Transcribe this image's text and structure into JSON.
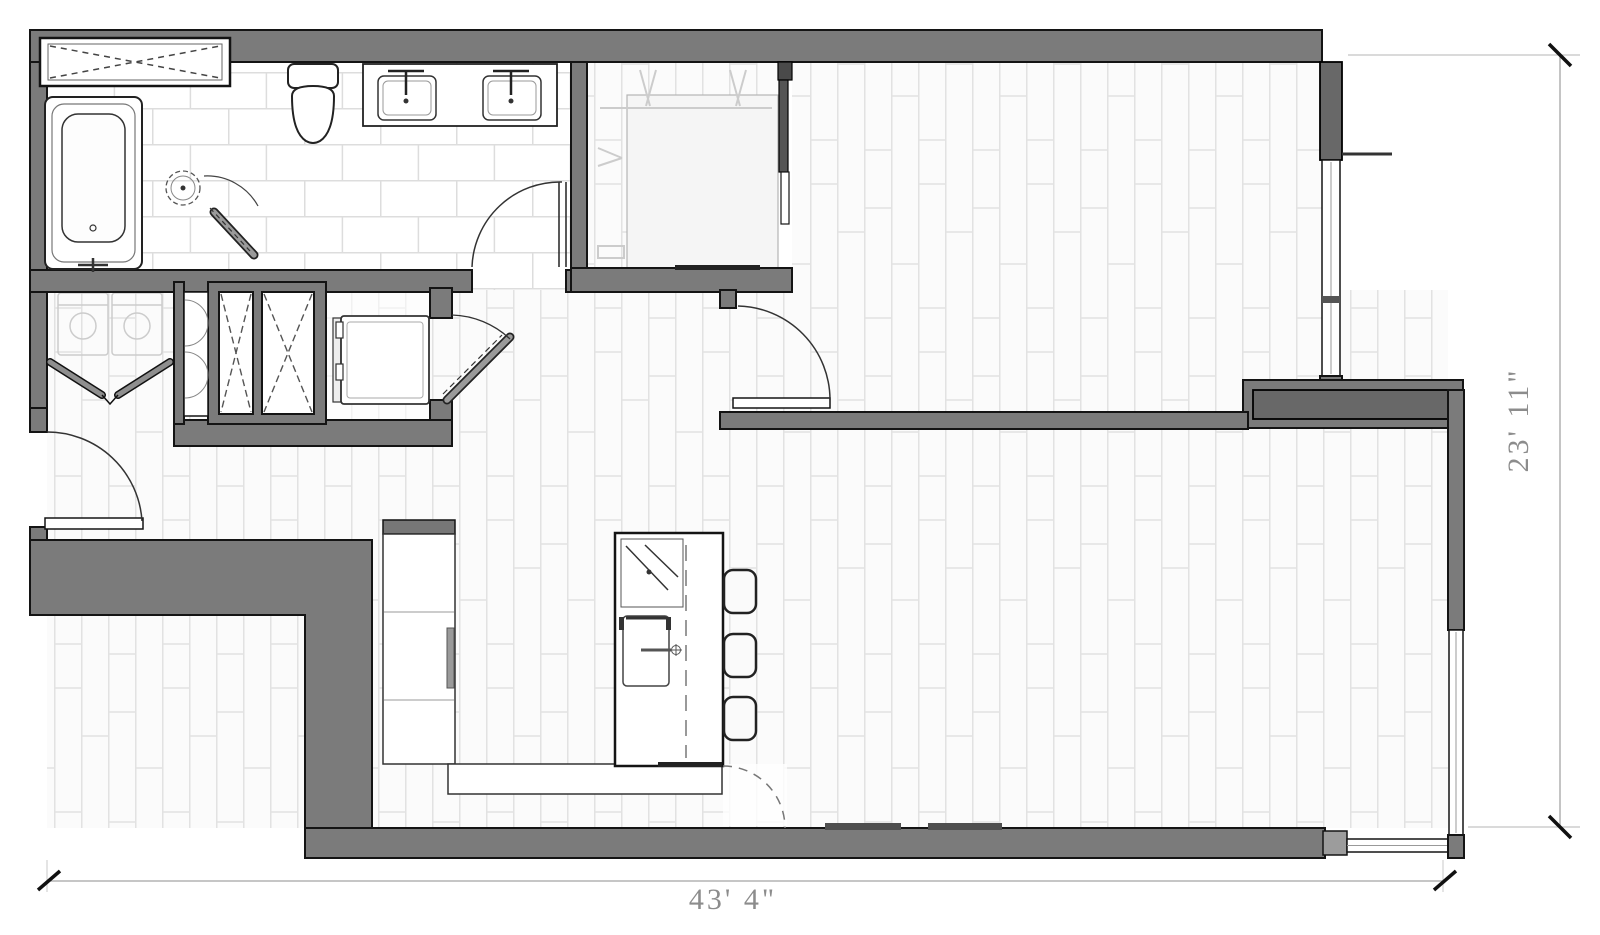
{
  "floorplan": {
    "dimensions": {
      "width_label": "43' 4\"",
      "height_label": "23' 11\""
    },
    "palette": {
      "wall_fill": "#7b7b7b",
      "wall_outline": "#141414",
      "wall_inner_band": "#686868",
      "plank_joint": "#e2e2e2",
      "tile_joint": "#dddddd",
      "fixture_outline": "#222222",
      "dimension_line": "#a5a5a5",
      "dimension_text": "#8c8c8c",
      "background": "#ffffff"
    }
  }
}
